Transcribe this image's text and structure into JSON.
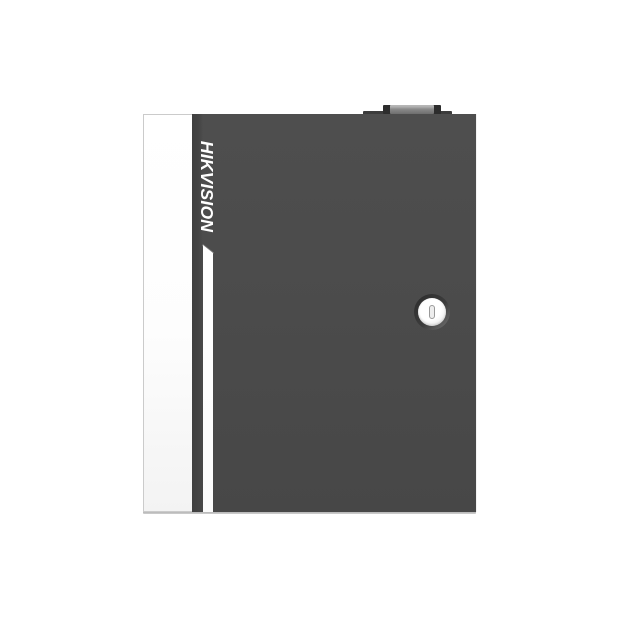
{
  "product": {
    "brand": "HIKVISION",
    "scene": "product photo of a dark grey wall-mount metal enclosure (access controller cabinet) with white left side panel, vertical brand wordmark, white accent stripe on the door edge, a small latch on the top edge and a round key lock on the right side of the door"
  },
  "colors": {
    "background": "#ffffff",
    "door": "#4b4b4b",
    "door-edge": "#3f3f3f",
    "panel-border": "#cbcbcb",
    "stripe": "#ffffff",
    "bevel": "#7a7a7a",
    "latch-base": "#3c3c3c",
    "latch-cap": "#2d2d2d",
    "latch-face": "#8b8b8b",
    "lock-ring": "#3c3c3c",
    "lock-face": "#ffffff",
    "lock-rim": "#d5d5d5",
    "keyhole-fill": "#ededed",
    "keyhole-border": "#999999",
    "ground": "#a8a8a8",
    "brand-text": "#ffffff"
  }
}
